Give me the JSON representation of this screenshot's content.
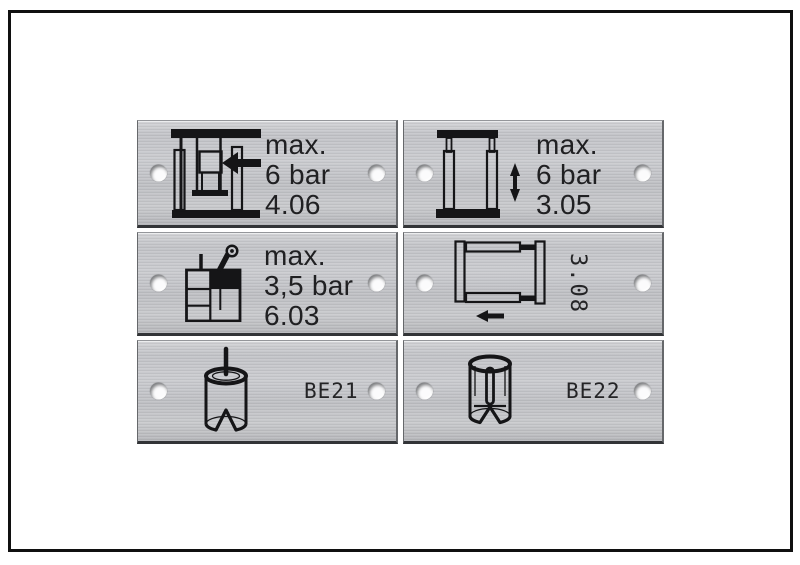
{
  "photo": {
    "description": "Six engraved brushed-aluminium machine label plates with mounting holes, arranged 2 x 3 inside a black border frame",
    "background": "#ffffff",
    "frame_color": "#101010",
    "plate_color": "#c5c6ca",
    "ink_color": "#1d1d1f"
  },
  "plates": [
    {
      "name": "plate-press-4-06",
      "icon": "press-unit-icon",
      "lines": [
        "max.",
        "6 bar",
        "4.06"
      ]
    },
    {
      "name": "plate-lift-3-05",
      "icon": "vertical-slide-icon",
      "lines": [
        "max.",
        "6 bar",
        "3.05"
      ]
    },
    {
      "name": "plate-tank-6-03",
      "icon": "tank-gauge-icon",
      "lines": [
        "max.",
        "3,5 bar",
        "6.03"
      ]
    },
    {
      "name": "plate-slide-3-08",
      "icon": "horizontal-slide-icon",
      "rotated_label": "3.08"
    },
    {
      "name": "plate-be21",
      "icon": "bushing-pin-icon",
      "label": "BE21"
    },
    {
      "name": "plate-be22",
      "icon": "bushing-cutaway-icon",
      "label": "BE22"
    }
  ]
}
